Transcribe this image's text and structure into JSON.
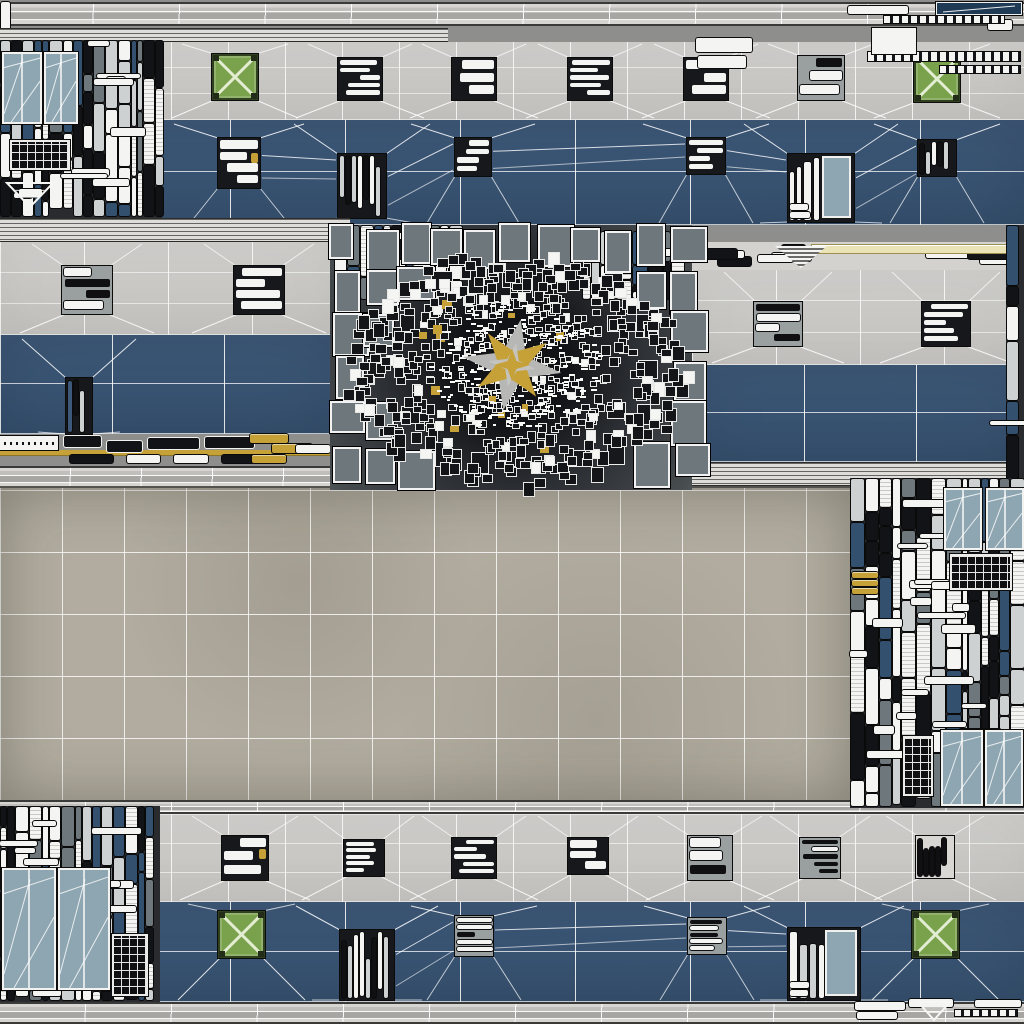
{
  "canvas": {
    "width": 1024,
    "height": 1024
  },
  "palette": {
    "background": "#8e8e8c",
    "beam_light": "#d6d5d2",
    "beam_mid": "#c0bfbc",
    "beam_dark": "#a7a6a3",
    "beam_edge": "#3a3a38",
    "wall_gray_light": "#d1d0cd",
    "wall_gray": "#c4c3c0",
    "wall_blue": "#3d5878",
    "wall_blue_dark": "#35506e",
    "plaza": "#b1ac9f",
    "plaza_edge": "#55534e",
    "grid_line": "#ffffff",
    "louver": "#deddda",
    "paper": "#f4f4f2",
    "ink": "#121316",
    "slate": "#6e787c",
    "slate_light": "#cdd1d2",
    "glass": "#8ea6b2",
    "navy": "#1e3a55",
    "crate_green": "#7aa24d",
    "crate_x": "#e3edd1",
    "gold": "#c6a138",
    "cream": "#eae3b8",
    "mosaic_core": "#121316",
    "star_gray": "#b7b7b5"
  },
  "regions": [
    {
      "name": "top-beam",
      "type": "beam",
      "rect": [
        8,
        2,
        1016,
        24
      ],
      "cell": 85
    },
    {
      "name": "left-edge-strip",
      "type": "corner",
      "rect": [
        0,
        2,
        12,
        32
      ],
      "pills": [
        [
          1,
          0,
          9,
          30
        ]
      ]
    },
    {
      "name": "top-left-louver",
      "type": "louver",
      "rect": [
        0,
        28,
        448,
        14
      ]
    },
    {
      "name": "top-wall",
      "type": "wall",
      "rect": [
        0,
        42,
        1024,
        183
      ],
      "gray": [
        0,
        0,
        1024,
        78
      ],
      "blue": [
        0,
        78,
        1024,
        105
      ],
      "grayGrid": 57,
      "blueGrid": 115,
      "grayPatches": [
        {
          "x": 338,
          "y": 16,
          "w": 44,
          "h": 42
        },
        {
          "x": 452,
          "y": 16,
          "w": 44,
          "h": 42
        },
        {
          "x": 568,
          "y": 16,
          "w": 44,
          "h": 42
        },
        {
          "x": 684,
          "y": 16,
          "w": 44,
          "h": 42
        },
        {
          "x": 798,
          "y": 14,
          "w": 46,
          "h": 44
        }
      ],
      "crates": [
        {
          "x": 212,
          "y": 12,
          "s": 46
        },
        {
          "x": 914,
          "y": 14,
          "s": 46
        }
      ],
      "bluePatches": [
        {
          "x": 218,
          "y": 96,
          "w": 42,
          "h": 50,
          "gold": 1
        },
        {
          "x": 338,
          "y": 112,
          "w": 48,
          "h": 64,
          "style": "slats"
        },
        {
          "x": 455,
          "y": 96,
          "w": 36,
          "h": 38
        },
        {
          "x": 687,
          "y": 96,
          "w": 38,
          "h": 36
        },
        {
          "x": 788,
          "y": 112,
          "w": 66,
          "h": 68,
          "style": "glassSlats"
        },
        {
          "x": 918,
          "y": 98,
          "w": 38,
          "h": 36,
          "style": "slats"
        }
      ]
    },
    {
      "name": "top-left-window-cluster",
      "type": "cluster",
      "rect": [
        0,
        40,
        162,
        178
      ],
      "seed": 11,
      "features": [
        {
          "kind": "window",
          "rect": [
            2,
            12,
            40,
            72
          ]
        },
        {
          "kind": "window",
          "rect": [
            44,
            12,
            34,
            72
          ]
        },
        {
          "kind": "lattice",
          "rect": [
            10,
            100,
            60,
            30
          ]
        },
        {
          "kind": "triangle",
          "rect": [
            6,
            142,
            48,
            26
          ]
        }
      ]
    },
    {
      "name": "top-right-corner-patches",
      "type": "corner",
      "rect": [
        688,
        0,
        336,
        80
      ],
      "navyBar": [
        248,
        2,
        86,
        13
      ],
      "whiteBox": [
        184,
        28,
        44,
        26
      ],
      "dashes": [
        [
          196,
          16,
          120,
          7
        ],
        [
          180,
          52,
          152,
          9
        ],
        [
          252,
          66,
          80,
          7
        ]
      ],
      "pills": [
        [
          8,
          38,
          56,
          14
        ],
        [
          10,
          56,
          48,
          12
        ],
        [
          300,
          20,
          24,
          10
        ],
        [
          160,
          6,
          60,
          8
        ]
      ]
    },
    {
      "name": "mid-left-louver",
      "type": "louver",
      "rect": [
        0,
        218,
        350,
        24
      ]
    },
    {
      "name": "mid-left-wall",
      "type": "wall",
      "rect": [
        0,
        242,
        336,
        224
      ],
      "gray": [
        0,
        0,
        336,
        93
      ],
      "blue": [
        0,
        93,
        336,
        99
      ],
      "grayGrid": 84,
      "blueGrid": 112,
      "grayPatches": [
        {
          "x": 62,
          "y": 24,
          "w": 50,
          "h": 48
        },
        {
          "x": 234,
          "y": 24,
          "w": 50,
          "h": 48
        }
      ],
      "crates": [],
      "bluePatches": [
        {
          "x": 66,
          "y": 136,
          "w": 26,
          "h": 56,
          "style": "slats"
        }
      ]
    },
    {
      "name": "mid-left-patch-row",
      "type": "patchRow",
      "rect": [
        0,
        432,
        336,
        34
      ],
      "seed": 21
    },
    {
      "name": "mid-left-beam",
      "type": "beam",
      "rect": [
        0,
        466,
        336,
        22
      ],
      "cell": 70
    },
    {
      "name": "mid-right-wall",
      "type": "wall",
      "rect": [
        692,
        242,
        332,
        220
      ],
      "topStrip": {
        "h": 28,
        "creamBar": [
          120,
          3,
          210,
          8
        ],
        "hatch": [
          83,
          4,
          52,
          22
        ]
      },
      "gray": [
        0,
        28,
        332,
        95
      ],
      "blue": [
        0,
        123,
        332,
        97
      ],
      "grayGrid": 84,
      "blueGrid": 112,
      "grayPatches": [
        {
          "x": 62,
          "y": 60,
          "w": 48,
          "h": 44
        },
        {
          "x": 230,
          "y": 60,
          "w": 48,
          "h": 44
        }
      ],
      "crates": [],
      "bluePatches": []
    },
    {
      "name": "mid-right-louver",
      "type": "louver",
      "rect": [
        692,
        462,
        332,
        24
      ]
    },
    {
      "name": "plaza-floor",
      "type": "plaza",
      "rect": [
        0,
        486,
        852,
        315
      ],
      "cell": 62
    },
    {
      "name": "center-mosaic",
      "type": "mosaic",
      "rect": [
        330,
        225,
        362,
        265
      ],
      "center": [
        182,
        140
      ],
      "seed": 5,
      "slatFeatures": [
        [
          4,
          0,
          126,
          76
        ],
        [
          252,
          6,
          106,
          70
        ]
      ]
    },
    {
      "name": "far-right-strip",
      "type": "cluster",
      "rect": [
        1006,
        225,
        18,
        262
      ],
      "seed": 31,
      "features": []
    },
    {
      "name": "bottom-beam",
      "type": "beam",
      "rect": [
        0,
        800,
        1024,
        14
      ],
      "cell": 85
    },
    {
      "name": "bottom-wall",
      "type": "wall",
      "rect": [
        0,
        814,
        1024,
        188
      ],
      "gray": [
        0,
        0,
        1024,
        88
      ],
      "blue": [
        0,
        88,
        1024,
        100
      ],
      "grayGrid": 57,
      "blueGrid": 115,
      "grayPatches": [
        {
          "x": 222,
          "y": 22,
          "w": 46,
          "h": 44,
          "gold": 1
        },
        {
          "x": 344,
          "y": 26,
          "w": 40,
          "h": 36
        },
        {
          "x": 452,
          "y": 24,
          "w": 44,
          "h": 40
        },
        {
          "x": 568,
          "y": 24,
          "w": 40,
          "h": 36
        },
        {
          "x": 688,
          "y": 22,
          "w": 44,
          "h": 44
        },
        {
          "x": 800,
          "y": 24,
          "w": 40,
          "h": 40
        },
        {
          "x": 916,
          "y": 22,
          "w": 38,
          "h": 42,
          "style": "slatsDark"
        }
      ],
      "crates": [
        {
          "x": 218,
          "y": 97,
          "s": 47
        },
        {
          "x": 912,
          "y": 97,
          "s": 47
        }
      ],
      "bluePatches": [
        {
          "x": 340,
          "y": 116,
          "w": 54,
          "h": 70,
          "style": "slats"
        },
        {
          "x": 455,
          "y": 102,
          "w": 38,
          "h": 40
        },
        {
          "x": 688,
          "y": 104,
          "w": 38,
          "h": 36
        },
        {
          "x": 788,
          "y": 114,
          "w": 72,
          "h": 72,
          "style": "glassSlats"
        }
      ]
    },
    {
      "name": "right-window-cluster",
      "type": "cluster",
      "rect": [
        850,
        478,
        174,
        330
      ],
      "seed": 41,
      "features": [
        {
          "kind": "window",
          "rect": [
            94,
            10,
            38,
            62
          ]
        },
        {
          "kind": "window",
          "rect": [
            136,
            10,
            38,
            62
          ]
        },
        {
          "kind": "lattice",
          "rect": [
            100,
            76,
            62,
            36
          ]
        },
        {
          "kind": "goldBars",
          "rect": [
            2,
            94,
            26,
            24
          ]
        },
        {
          "kind": "window",
          "rect": [
            91,
            252,
            42,
            76
          ]
        },
        {
          "kind": "window",
          "rect": [
            135,
            252,
            38,
            76
          ]
        },
        {
          "kind": "lattice",
          "rect": [
            53,
            258,
            30,
            60
          ]
        }
      ]
    },
    {
      "name": "bottom-left-window-cluster",
      "type": "cluster",
      "rect": [
        0,
        806,
        160,
        196
      ],
      "seed": 51,
      "features": [
        {
          "kind": "window",
          "rect": [
            2,
            62,
            54,
            122
          ]
        },
        {
          "kind": "window",
          "rect": [
            58,
            62,
            52,
            122
          ]
        },
        {
          "kind": "lattice",
          "rect": [
            112,
            128,
            36,
            62
          ]
        }
      ]
    },
    {
      "name": "base-beam",
      "type": "beam",
      "rect": [
        0,
        1002,
        1024,
        22
      ],
      "cell": 85
    },
    {
      "name": "bottom-right-corner-patches",
      "type": "corner",
      "rect": [
        855,
        998,
        169,
        26
      ],
      "dashes": [
        [
          100,
          12,
          62,
          6
        ]
      ],
      "pills": [
        [
          0,
          4,
          50,
          8
        ],
        [
          54,
          1,
          44,
          8
        ],
        [
          2,
          14,
          40,
          7
        ],
        [
          120,
          2,
          46,
          7
        ]
      ],
      "triangle": [
        62,
        3,
        34,
        20
      ]
    }
  ]
}
